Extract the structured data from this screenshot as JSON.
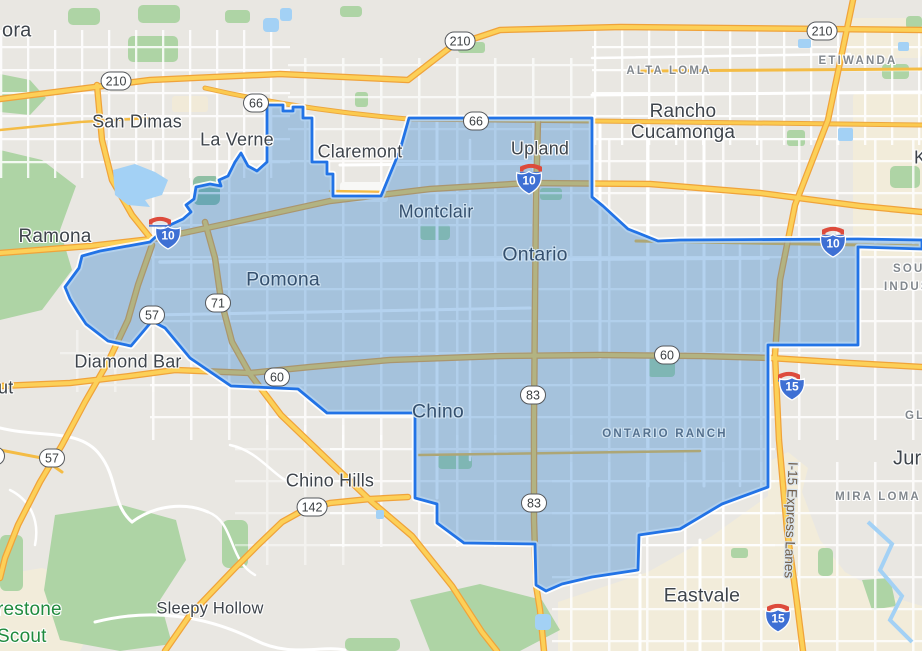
{
  "map_type": "road-map with highlighted municipal region",
  "colors": {
    "land": "#e9e7e2",
    "urban_tan": "#f2ecda",
    "park_green": "#aed4a5",
    "water_blue": "#a3d1f5",
    "highway_yellow": "#fcd058",
    "highway_casing": "#f0a33a",
    "region_fill": "rgba(40,125,210,0.35)",
    "region_stroke": "#2273e6",
    "interstate_blue": "#3e70d4",
    "bridge_icon_red": "#dd4b3c"
  },
  "cities": {
    "glendora_partial": "ora",
    "san_dimas": "San Dimas",
    "la_verne": "La Verne",
    "claremont": "Claremont",
    "upland": "Upland",
    "montclair": "Montclair",
    "ontario": "Ontario",
    "pomona": "Pomona",
    "ramona": "Ramona",
    "diamond_bar": "Diamond Bar",
    "walnut_partial": "ut",
    "chino": "Chino",
    "chino_hills": "Chino Hills",
    "sleepy_hollow": "Sleepy Hollow",
    "eastvale": "Eastvale",
    "rancho_cucamonga": "Rancho Cucamonga",
    "jurupa_partial": "Jur",
    "east_edge_partial": "K"
  },
  "districts": {
    "alta_loma": "ALTA LOMA",
    "etiwanda": "ETIWANDA",
    "ontario_ranch": "ONTARIO RANCH",
    "mira_loma": "MIRA LOMA",
    "south_partial": "SOU",
    "industrial_partial": "INDUS",
    "gl_partial": "GL"
  },
  "parks": {
    "firestone_line1": "restone",
    "firestone_line2": "Scout"
  },
  "road_names": {
    "i15_express_lanes": "I-15 Express Lanes"
  },
  "shields": {
    "sr210": "210",
    "sr66": "66",
    "sr57": "57",
    "sr71": "71",
    "sr60": "60",
    "sr83": "83",
    "sr142": "142",
    "i10": "10",
    "i15": "15"
  }
}
